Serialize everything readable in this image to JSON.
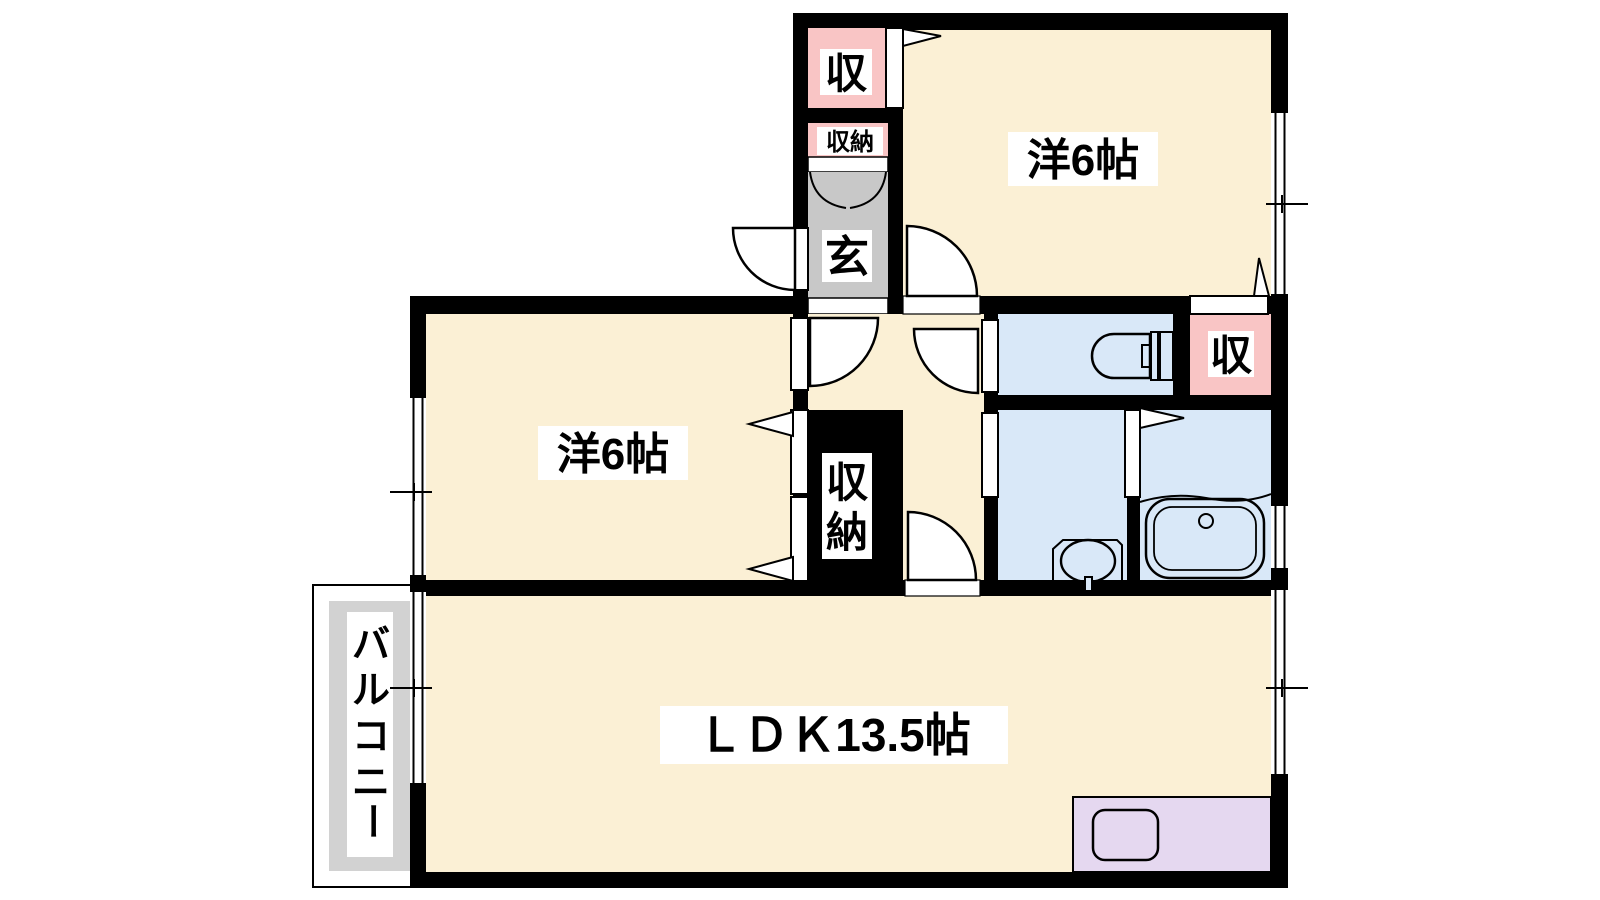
{
  "plan": {
    "type": "japanese-apartment-floor-plan",
    "layout_name": "2LDK"
  },
  "labels": {
    "bedroom_top": "洋6帖",
    "bedroom_left": "洋6帖",
    "ldk": "ＬＤＫ13.5帖",
    "closet_top": "収",
    "closet_right": "収",
    "shoe_storage": "収納",
    "entrance": "玄",
    "storage_chars": [
      "収",
      "納"
    ],
    "balcony_chars": [
      "バ",
      "ル",
      "コ",
      "ニ",
      "ー"
    ]
  },
  "fixtures": {
    "toilet": "toilet-icon",
    "bathtub": "bathtub-icon",
    "washbasin": "washbasin-icon",
    "kitchen_sink": "kitchen-sink-icon"
  },
  "colors": {
    "room_cream": "#FBF0D5",
    "closet_pink": "#F9C5C5",
    "wet_area_blue": "#D9E8F8",
    "kitchen_purple": "#E5D8F0",
    "entrance_gray": "#C8C8C8",
    "balcony_gray": "#D2D2D2",
    "wall_black": "#000000",
    "label_bg": "#FFFFFF"
  }
}
